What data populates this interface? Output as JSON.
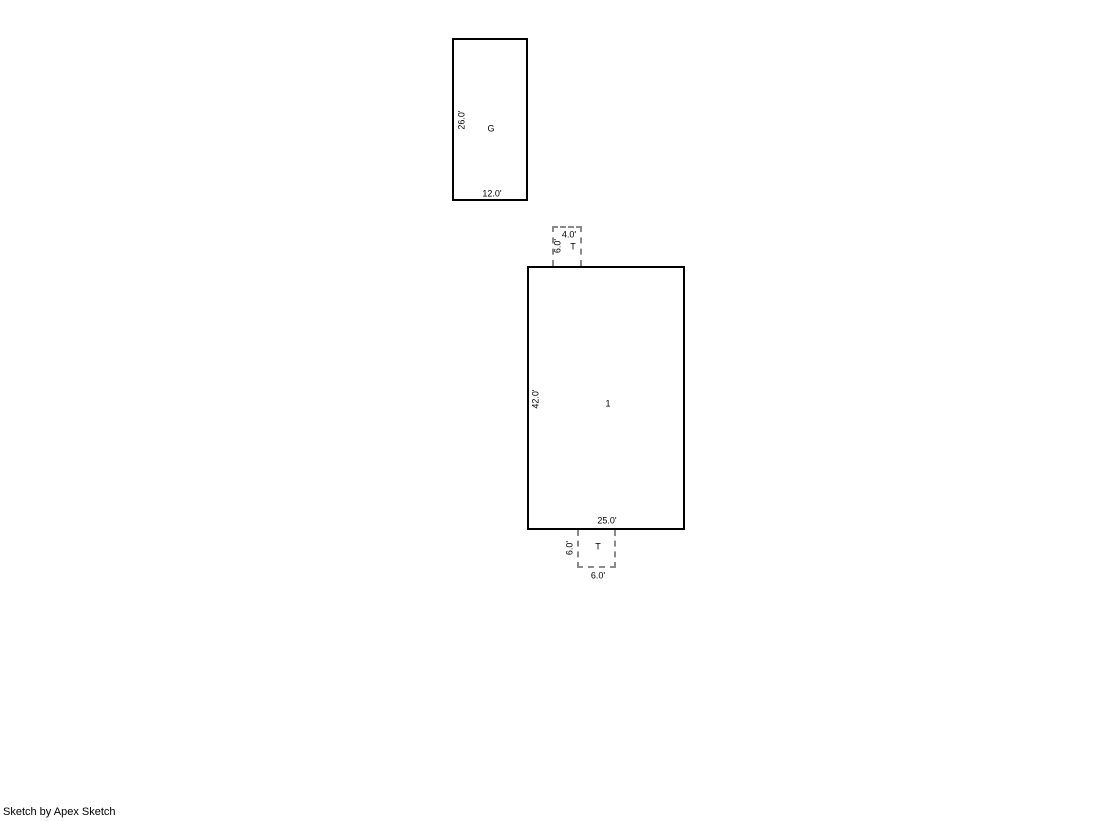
{
  "page": {
    "background": "#ffffff"
  },
  "colors": {
    "wall_outline": "#000000",
    "attachment_outline": "#8a8a8a"
  },
  "areas": {
    "garage": {
      "label": "G",
      "bottom_dim": "12.0'",
      "left_dim": "26.0'"
    },
    "main": {
      "label": "1",
      "bottom_dim": "25.0'",
      "left_dim": "42.0'"
    },
    "t_top": {
      "label": "T",
      "top_dim": "4.0'",
      "left_dim": "6.0'"
    },
    "t_bottom": {
      "label": "T",
      "bottom_dim": "6.0'",
      "left_dim": "6.0'"
    }
  },
  "footer": {
    "credit": "Sketch by Apex Sketch"
  }
}
